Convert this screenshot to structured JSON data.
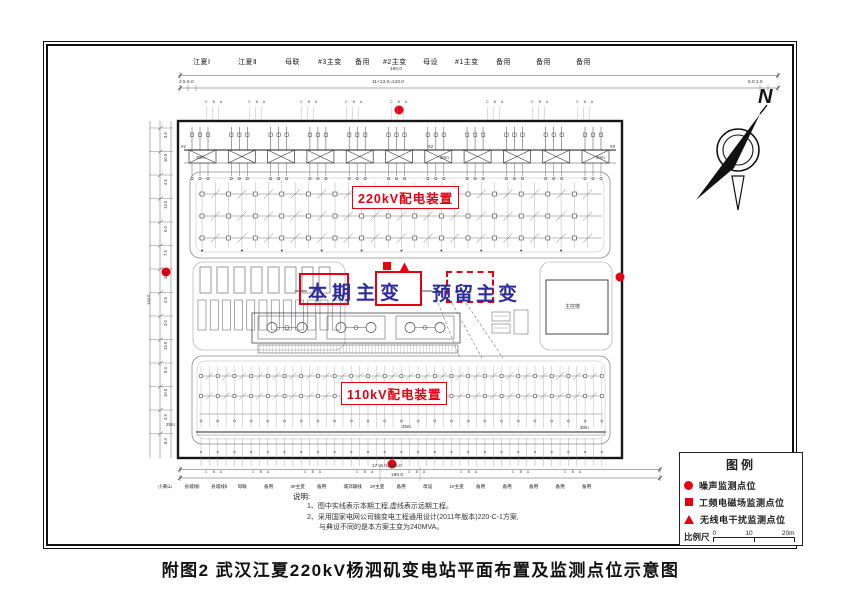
{
  "title": "附图2 武汉江夏220kV杨泗矶变电站平面布置及监测点位示意图",
  "compass": {
    "north_label": "N"
  },
  "bays": {
    "top": [
      "江夏Ⅰ",
      "江夏Ⅱ",
      "母联",
      "#3主变",
      "备用",
      "#2主变",
      "母设",
      "#1主变",
      "备用",
      "备用",
      "备用"
    ],
    "bottom": [
      "小黄山",
      "县城线Ⅰ",
      "县城线Ⅱ",
      "母联",
      "备用",
      "3#主变",
      "备用",
      "城郊输线",
      "2#主变",
      "备用",
      "母设",
      "1#主变",
      "备用",
      "备用",
      "备用",
      "备用",
      "备用"
    ],
    "phase_letters": "C B A"
  },
  "areas": {
    "kv220": "220kV配电装置",
    "kv110": "110kV配电装置",
    "main_transformer": "本期主变",
    "reserved_transformer": "预留主变",
    "control_building": "主控楼"
  },
  "bus_points": [
    "#1",
    "#2",
    "#3"
  ],
  "distances": {
    "top": [
      "30m",
      "30m",
      "30m"
    ],
    "bottom": [
      "25m",
      "25m",
      "30m"
    ]
  },
  "dimensions": {
    "top_total": "190.0",
    "top_run": "11×13.0=143.0",
    "margin_left": "2.5  6.0",
    "margin_right": "6.0  2.5",
    "bottom_run": "17×8.0=136.0",
    "bottom_total": "190.0",
    "left_total": "144.0",
    "left_ticks": [
      "3.5",
      "10.5",
      "4.5",
      "13.0",
      "5.0",
      "7.5",
      "13.0",
      "4.5",
      "3.0",
      "13.0",
      "5.4",
      "10.5",
      "4.5",
      "8.4"
    ]
  },
  "notes": {
    "heading": "说明:",
    "lines": [
      "1、图中实线表示本期工程,虚线表示远期工程。",
      "2、采用国家电网公司输变电工程通用设计(2011年版本)220-C-1方案,",
      "与典设不同的是本方案主变为240MVA。"
    ]
  },
  "legend": {
    "title": "图例",
    "items": [
      {
        "symbol": "noise-dot",
        "label": "噪声监测点位"
      },
      {
        "symbol": "emf-square",
        "label": "工频电磁场监测点位"
      },
      {
        "symbol": "radio-triangle",
        "label": "无线电干扰监测点位"
      }
    ],
    "scale": {
      "label": "比例尺",
      "ticks": [
        "0",
        "10",
        "20m"
      ]
    }
  },
  "colors": {
    "accent_red": "#e60012",
    "label_blue": "#2c2c9c"
  }
}
